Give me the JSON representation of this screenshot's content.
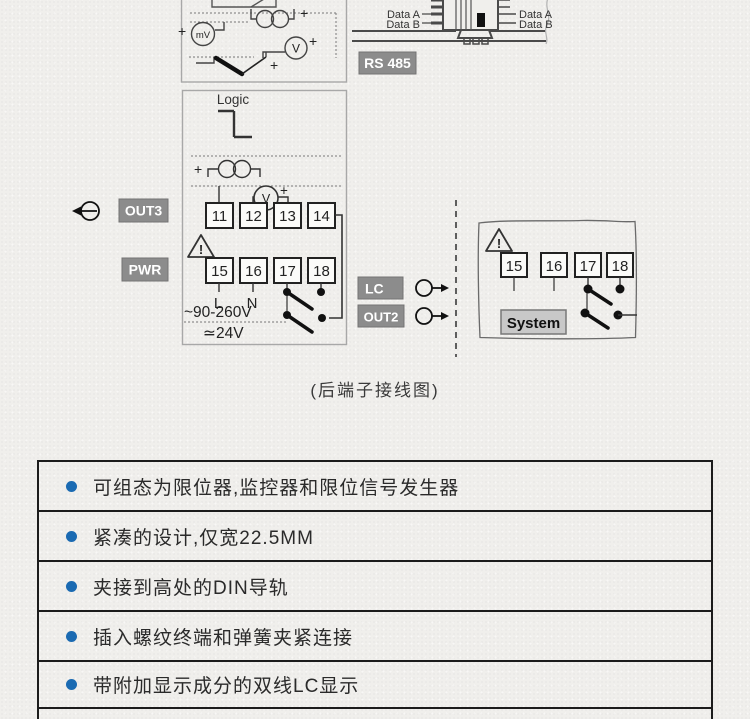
{
  "colors": {
    "page_bg": "#f0efec",
    "badge_bg": "#8c8c8c",
    "badge_text": "#ffffff",
    "system_badge_bg": "#c8c8c8",
    "bullet_blue": "#1a6ab2",
    "table_border": "#1c1c1c",
    "line_dark": "#333333"
  },
  "sensor_box": {
    "ct_plus": "+",
    "mv_plus": "+",
    "mv": "mV",
    "v": "V",
    "v_plus": "+",
    "tc_plus": "+"
  },
  "rs485": {
    "left_a": "Data A",
    "left_b": "Data B",
    "right_a": "Data A",
    "right_b": "Data B",
    "badge": "RS 485"
  },
  "logic_box": {
    "title": "Logic",
    "ct_plus": "+",
    "v": "V",
    "v_plus": "+",
    "warning": "!",
    "terminals_top": [
      "11",
      "12",
      "13",
      "14"
    ],
    "terminals_bottom": [
      "15",
      "16",
      "17",
      "18"
    ],
    "line": "L",
    "neutral": "N",
    "ac_range": "~90-260V",
    "dc_range": "≃24V"
  },
  "badges": {
    "out3": "OUT3",
    "pwr": "PWR",
    "lc": "LC",
    "out2": "OUT2"
  },
  "system_box": {
    "warning": "!",
    "terminals": [
      "15",
      "16",
      "17",
      "18"
    ],
    "label": "System"
  },
  "caption": "(后端子接线图)",
  "features": [
    "可组态为限位器,监控器和限位信号发生器",
    "紧凑的设计,仅宽22.5MM",
    "夹接到高处的DIN导轨",
    "插入螺纹终端和弹簧夹紧连接",
    "带附加显示成分的双线LC显示"
  ]
}
